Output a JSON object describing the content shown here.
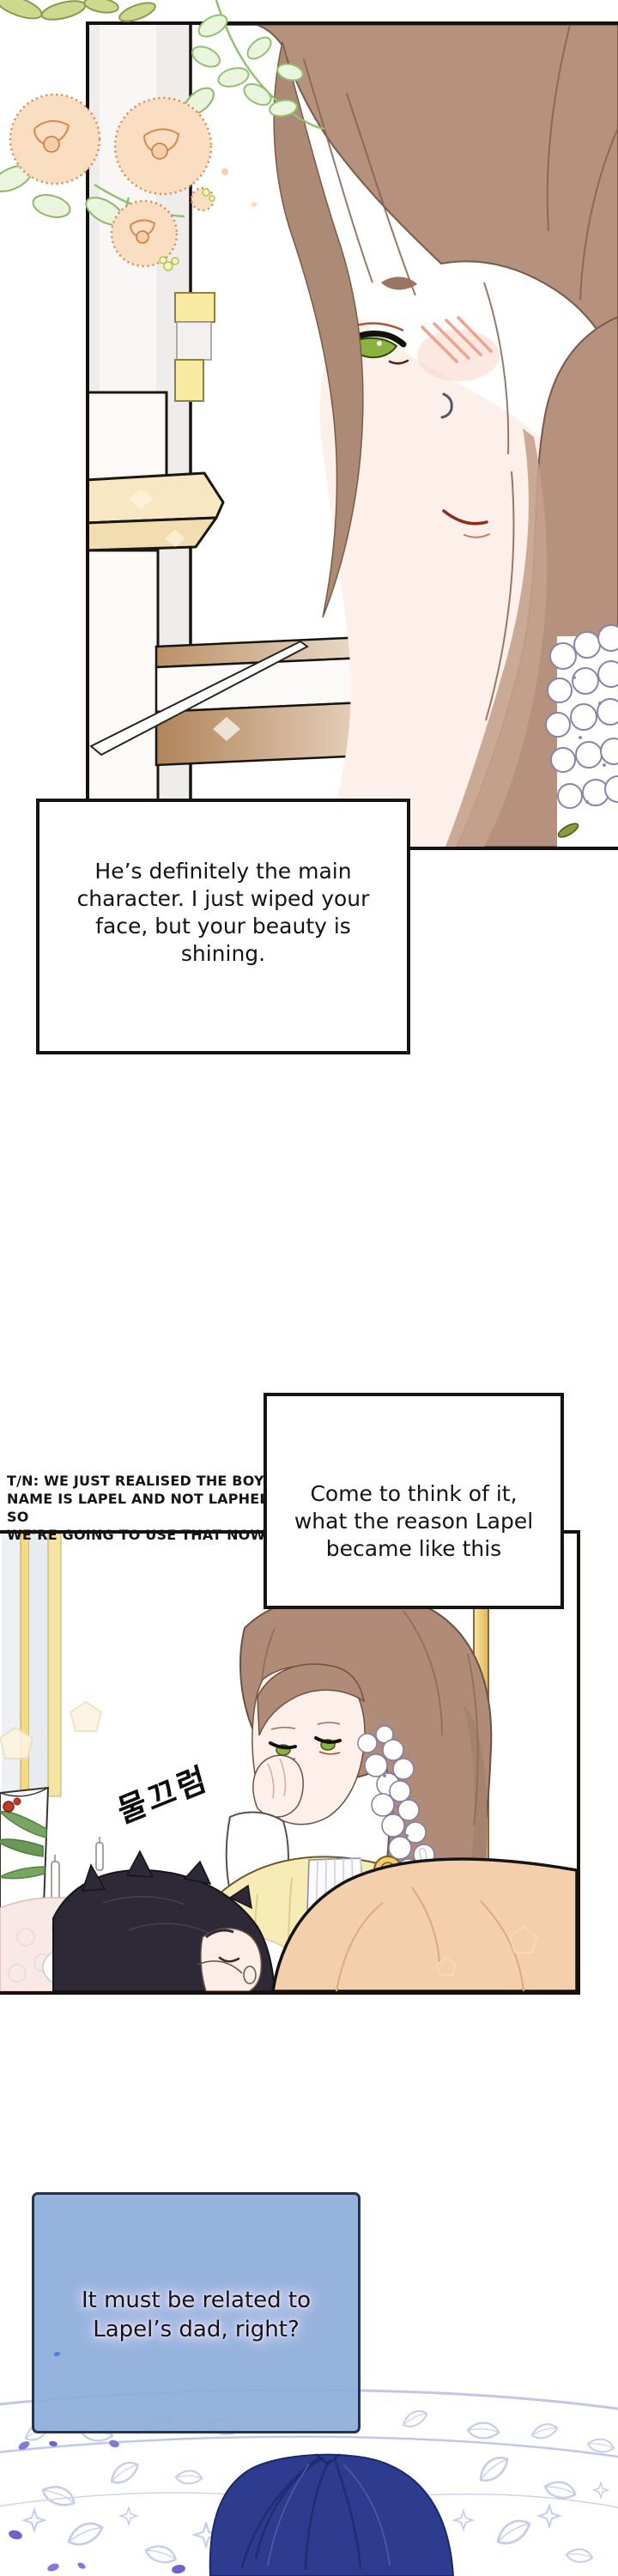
{
  "page": {
    "kind": "webtoon comic page",
    "background_color": "#ffffff"
  },
  "speech_bubbles": [
    {
      "id": "bubble-1",
      "shape": "rectangular box",
      "fill": "#ffffff",
      "border_color": "#141414",
      "lines": [
        "He’s definitely the main",
        "character. I just wiped your",
        "face, but your beauty is",
        "shining."
      ]
    },
    {
      "id": "bubble-2",
      "shape": "rectangular box",
      "fill": "#ffffff",
      "border_color": "#141414",
      "lines": [
        "Come to think of it,",
        "what the reason Lapel",
        "became like this"
      ]
    },
    {
      "id": "bubble-3",
      "shape": "rounded rectangular box",
      "fill": "#8eadda",
      "border_color": "#26334d",
      "text_glow_color": "#e9dcf8",
      "lines": [
        "It must be related to",
        "Lapel’s dad, right?"
      ]
    }
  ],
  "translator_note": {
    "lines": [
      "T/N: WE JUST REALISED THE BOY’S",
      "NAME IS LAPEL AND NOT LAPHELLE SO",
      "WE’RE GOING TO USE THAT NOW"
    ]
  },
  "sound_effect": {
    "text": "물끄럼"
  },
  "palette": {
    "panel_border": "#15110d",
    "hair_brown": "#b5917e",
    "hair_navy": "#2d3c8e",
    "skin": "#fdf0ea",
    "eye_green": "#8ab23d",
    "flower_peach": "#f9dec2",
    "flower_outline": "#d9884e",
    "leaf_green": "#93bf72",
    "dress_yellow": "#f8ecb6",
    "blanket_peach": "#f4cfab",
    "mandala_outline": "#bdc5ea",
    "petal_purple": "#8478d8",
    "curtain_yellow": "#f3dc80",
    "pillar_beige": "#f7e7c3"
  }
}
